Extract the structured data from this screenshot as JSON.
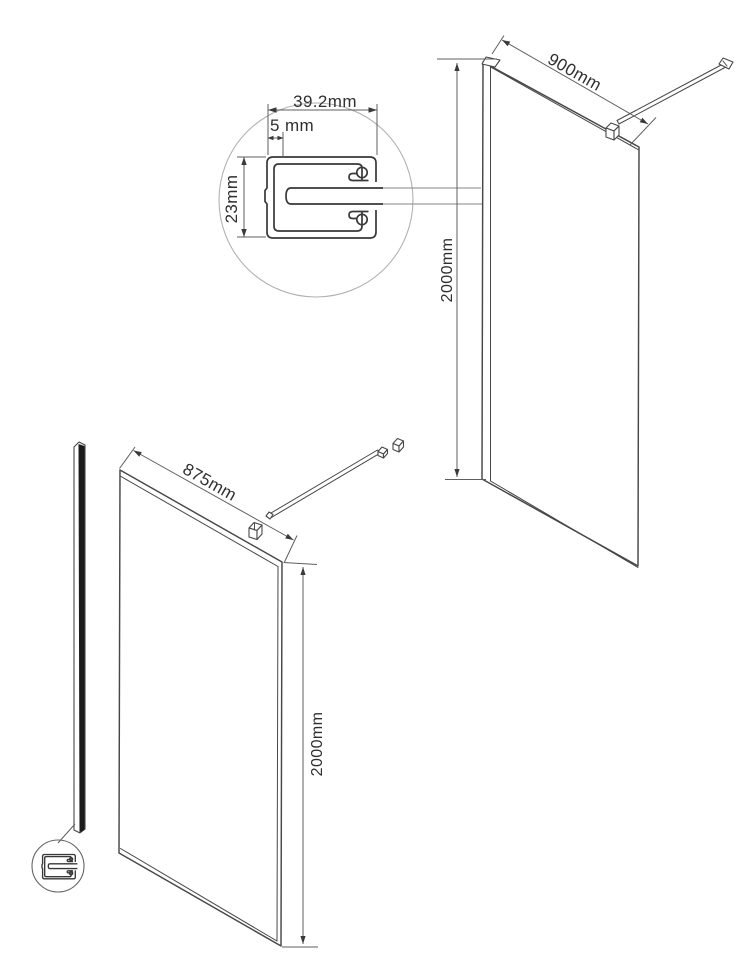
{
  "drawing": {
    "background_color": "#ffffff",
    "line_color": "#474747",
    "dimension_color": "#5f5f5f",
    "arrow_color": "#3a3a3a",
    "text_color": "#2f2f2f",
    "profile_fill_color": "#1c1c1c"
  },
  "detail_callout": {
    "width_label": "39.2mm",
    "wall_thickness_label": "5 mm",
    "height_label": "23mm"
  },
  "assembled_view": {
    "width_label": "900mm",
    "height_label": "2000mm"
  },
  "exploded_view": {
    "width_label": "875mm",
    "height_label": "2000mm"
  }
}
